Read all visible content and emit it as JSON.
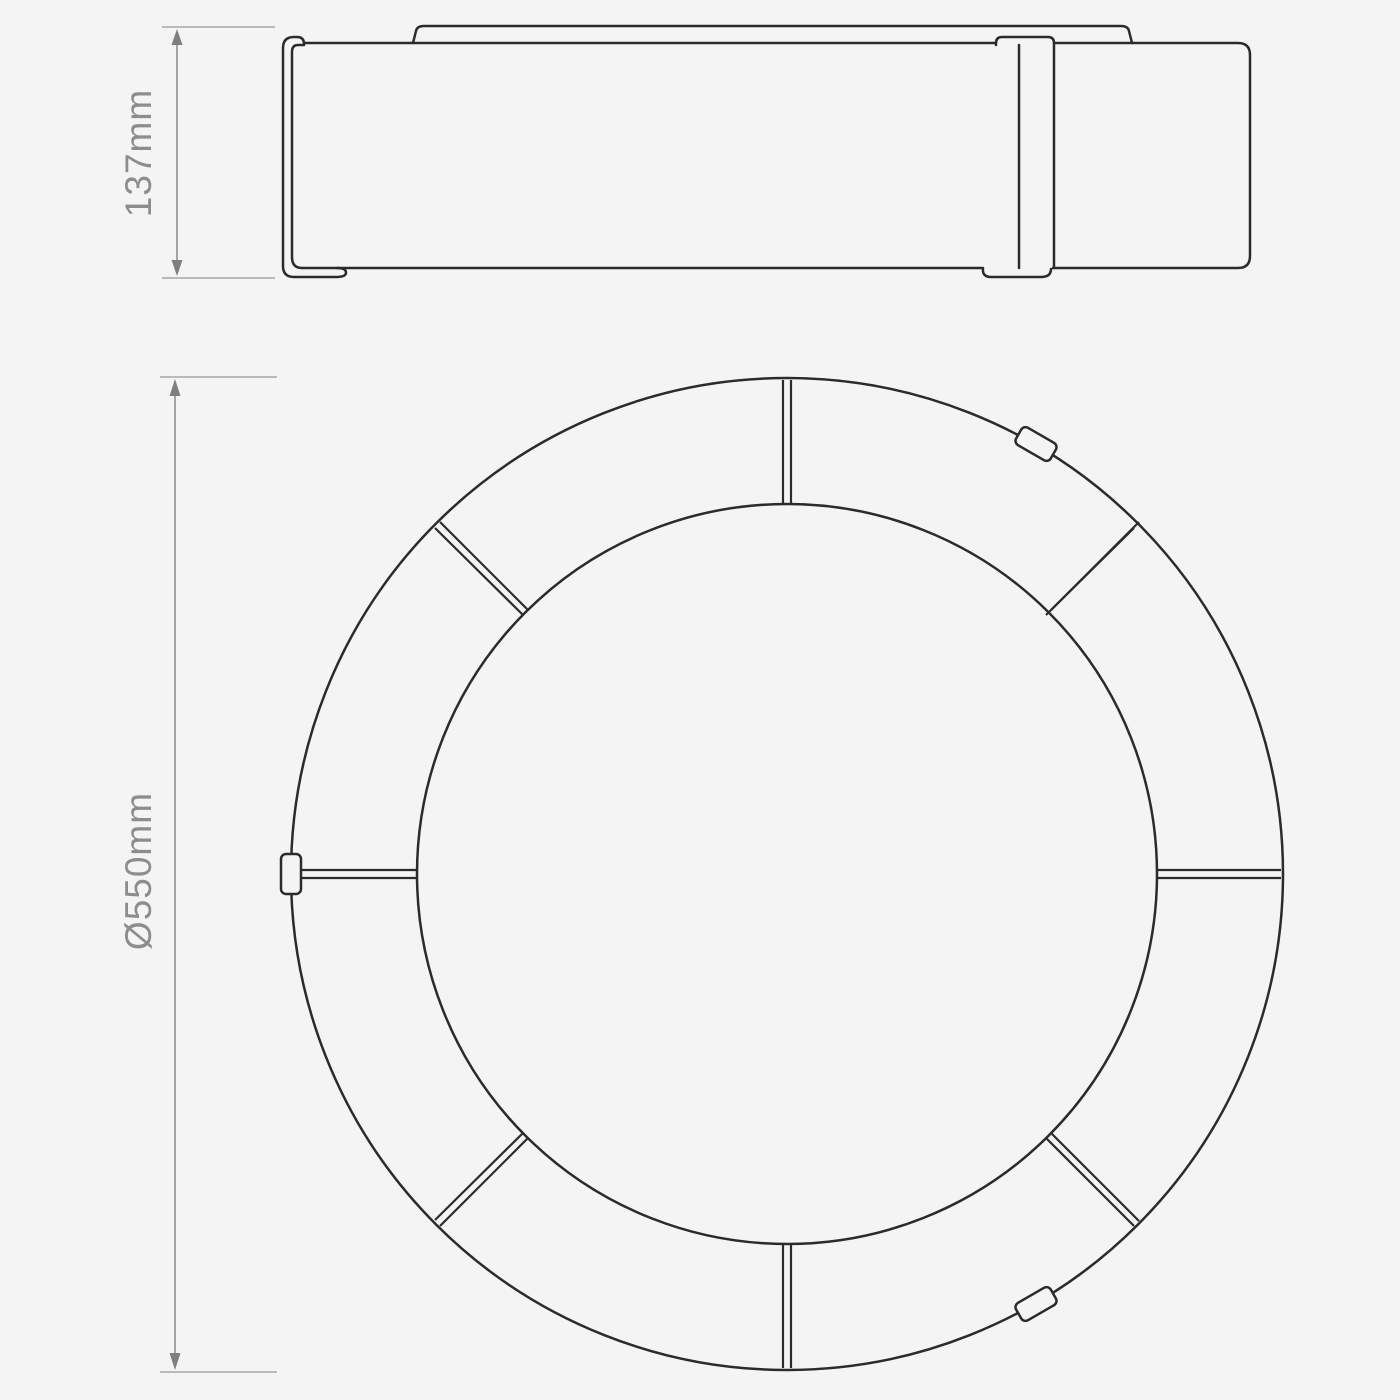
{
  "dimensions": {
    "height": {
      "label": "137mm"
    },
    "diameter": {
      "label": "Ø550mm"
    }
  },
  "plan_view": {
    "segment_count": 8,
    "clip_count": 3
  },
  "colors": {
    "background": "#f4f4f4",
    "outline": "#2b2b2b",
    "dimension_line": "#8f8f8f",
    "dimension_text": "#8d8d8d"
  }
}
